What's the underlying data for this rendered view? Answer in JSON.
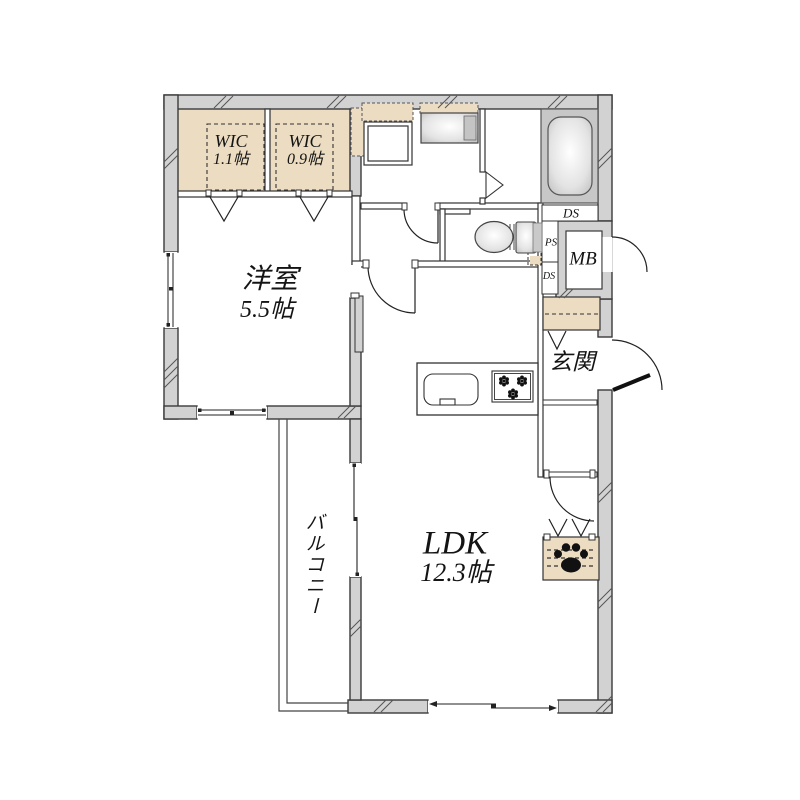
{
  "rooms": {
    "wic_left": {
      "name": "WIC",
      "area": "1.1帖"
    },
    "wic_right": {
      "name": "WIC",
      "area": "0.9帖"
    },
    "western_room": {
      "name": "洋室",
      "area": "5.5帖"
    },
    "ldk": {
      "name": "LDK",
      "area": "12.3帖"
    },
    "balcony": {
      "name": "バルコニー"
    },
    "entrance": {
      "name": "玄関"
    }
  },
  "utilities": {
    "meter_box": "MB",
    "duct_space_top": "DS",
    "pipe_space": "PS",
    "duct_space_mid": "DS"
  },
  "icons": {
    "pet_area": "paw-print-icon",
    "stove": "stove-burner-icon",
    "doors": "door-swing-arc"
  },
  "colors": {
    "wall_fill": "#d2d2d2",
    "closet_fill": "#ebdcc2",
    "tub_surround": "#c7c7c7",
    "line": "#333333",
    "paw": "#111111"
  }
}
